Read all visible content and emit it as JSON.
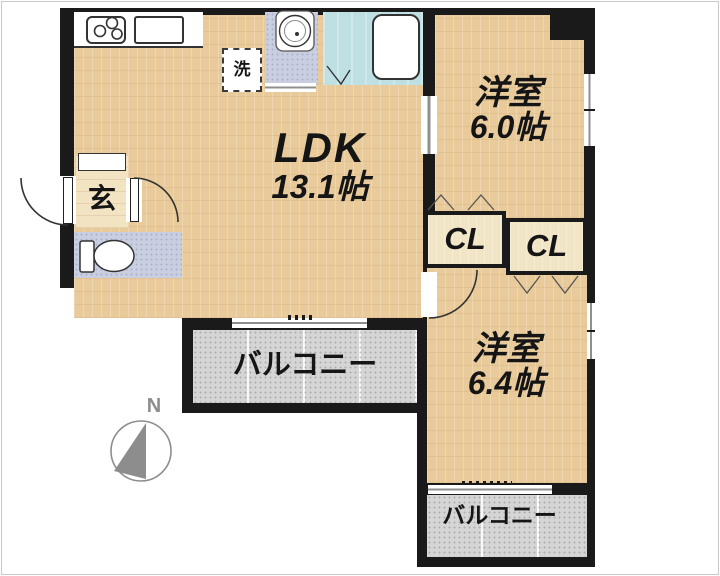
{
  "plan": {
    "rooms": {
      "ldk": {
        "label": "LDK",
        "size": "13.1帖"
      },
      "bedroom_north": {
        "label": "洋室",
        "size": "6.0帖"
      },
      "bedroom_south": {
        "label": "洋室",
        "size": "6.4帖"
      },
      "entrance": {
        "label": "玄"
      },
      "laundry": {
        "label": "洗"
      }
    },
    "closets": [
      {
        "label": "CL"
      },
      {
        "label": "CL"
      }
    ],
    "balconies": [
      {
        "label": "バルコニー"
      },
      {
        "label": "バルコニー"
      }
    ],
    "compass": {
      "label": "N"
    }
  },
  "colors": {
    "wall": "#1a1a1a",
    "wood": "#e9cb9b",
    "entrance_tile": "#f2e4c2",
    "closet": "#f2e5c5",
    "wet_room": "#c9cee1",
    "bathroom": "#bfe0e3",
    "balcony": "#d5d5d5",
    "window": "#ffffff",
    "compass": "#8d8d8d"
  }
}
